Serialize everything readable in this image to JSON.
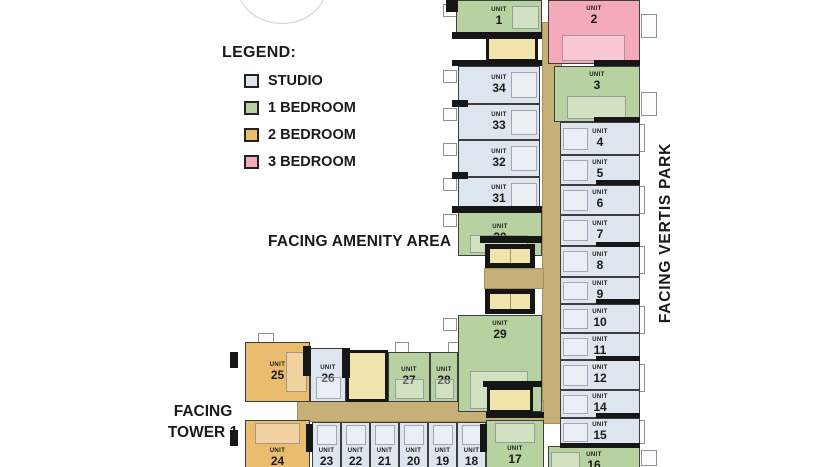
{
  "colors": {
    "studio": "#dde6ef",
    "br1": "#b8d1a0",
    "br2": "#e9bc6e",
    "br3": "#f4aab9",
    "corridor": "#c6b078",
    "service": "#f0e3ab",
    "wall": "#161616"
  },
  "legend": {
    "title": "LEGEND:",
    "items": [
      {
        "label": "STUDIO",
        "key": "studio"
      },
      {
        "label": "1 BEDROOM",
        "key": "br1"
      },
      {
        "label": "2 BEDROOM",
        "key": "br2"
      },
      {
        "label": "3 BEDROOM",
        "key": "br3"
      }
    ]
  },
  "labels": {
    "amenity": "FACING AMENITY AREA",
    "vertis": "FACING VERTIS PARK",
    "tower": "FACING\nTOWER 1"
  },
  "plan": {
    "unit_word": "UNIT",
    "units": [
      {
        "n": "1",
        "t": "br1",
        "x": 456,
        "y": 0,
        "w": 86,
        "h": 34,
        "o": "r"
      },
      {
        "n": "2",
        "t": "br3",
        "x": 548,
        "y": 0,
        "w": 92,
        "h": 64,
        "o": "b",
        "la": "t"
      },
      {
        "n": "3",
        "t": "br1",
        "x": 554,
        "y": 66,
        "w": 86,
        "h": 56,
        "o": "b",
        "la": "t"
      },
      {
        "n": "4",
        "t": "studio",
        "x": 560,
        "y": 122,
        "w": 80,
        "h": 33,
        "o": "l"
      },
      {
        "n": "5",
        "t": "studio",
        "x": 560,
        "y": 155,
        "w": 80,
        "h": 30,
        "o": "l"
      },
      {
        "n": "6",
        "t": "studio",
        "x": 560,
        "y": 185,
        "w": 80,
        "h": 30,
        "o": "l"
      },
      {
        "n": "7",
        "t": "studio",
        "x": 560,
        "y": 215,
        "w": 80,
        "h": 31,
        "o": "l"
      },
      {
        "n": "8",
        "t": "studio",
        "x": 560,
        "y": 246,
        "w": 80,
        "h": 31,
        "o": "l"
      },
      {
        "n": "9",
        "t": "studio",
        "x": 560,
        "y": 277,
        "w": 80,
        "h": 27,
        "o": "l"
      },
      {
        "n": "10",
        "t": "studio",
        "x": 560,
        "y": 304,
        "w": 80,
        "h": 29,
        "o": "l"
      },
      {
        "n": "11",
        "t": "studio",
        "x": 560,
        "y": 333,
        "w": 80,
        "h": 27,
        "o": "l"
      },
      {
        "n": "12",
        "t": "studio",
        "x": 560,
        "y": 360,
        "w": 80,
        "h": 30,
        "o": "l"
      },
      {
        "n": "14",
        "t": "studio",
        "x": 560,
        "y": 390,
        "w": 80,
        "h": 28,
        "o": "l"
      },
      {
        "n": "15",
        "t": "studio",
        "x": 560,
        "y": 418,
        "w": 80,
        "h": 28,
        "o": "l"
      },
      {
        "n": "16",
        "t": "br1",
        "x": 548,
        "y": 446,
        "w": 92,
        "h": 34,
        "o": "l",
        "la": "t"
      },
      {
        "n": "17",
        "t": "br1",
        "x": 486,
        "y": 420,
        "w": 58,
        "h": 50,
        "o": "t",
        "la": "b"
      },
      {
        "n": "18",
        "t": "studio",
        "x": 457,
        "y": 422,
        "w": 29,
        "h": 50,
        "o": "t",
        "la": "b"
      },
      {
        "n": "19",
        "t": "studio",
        "x": 428,
        "y": 422,
        "w": 29,
        "h": 50,
        "o": "t",
        "la": "b"
      },
      {
        "n": "20",
        "t": "studio",
        "x": 399,
        "y": 422,
        "w": 29,
        "h": 50,
        "o": "t",
        "la": "b"
      },
      {
        "n": "21",
        "t": "studio",
        "x": 370,
        "y": 422,
        "w": 29,
        "h": 50,
        "o": "t",
        "la": "b"
      },
      {
        "n": "22",
        "t": "studio",
        "x": 341,
        "y": 422,
        "w": 29,
        "h": 50,
        "o": "t",
        "la": "b"
      },
      {
        "n": "23",
        "t": "studio",
        "x": 312,
        "y": 422,
        "w": 29,
        "h": 50,
        "o": "t",
        "la": "b"
      },
      {
        "n": "24",
        "t": "br2",
        "x": 245,
        "y": 420,
        "w": 65,
        "h": 52,
        "o": "t",
        "la": "b"
      },
      {
        "n": "25",
        "t": "br2",
        "x": 245,
        "y": 342,
        "w": 65,
        "h": 60,
        "o": "r"
      },
      {
        "n": "26",
        "t": "studio",
        "x": 310,
        "y": 348,
        "w": 36,
        "h": 54,
        "o": "b"
      },
      {
        "n": "27",
        "t": "br1",
        "x": 388,
        "y": 352,
        "w": 42,
        "h": 50,
        "o": "b"
      },
      {
        "n": "28",
        "t": "br1",
        "x": 430,
        "y": 352,
        "w": 28,
        "h": 50,
        "o": "b"
      },
      {
        "n": "29",
        "t": "br1",
        "x": 458,
        "y": 315,
        "w": 84,
        "h": 97,
        "o": "b",
        "la": "t"
      },
      {
        "n": "30",
        "t": "br1",
        "x": 458,
        "y": 212,
        "w": 84,
        "h": 44,
        "o": "b"
      },
      {
        "n": "31",
        "t": "studio",
        "x": 458,
        "y": 177,
        "w": 82,
        "h": 35,
        "o": "r"
      },
      {
        "n": "32",
        "t": "studio",
        "x": 458,
        "y": 140,
        "w": 82,
        "h": 37,
        "o": "r"
      },
      {
        "n": "33",
        "t": "studio",
        "x": 458,
        "y": 104,
        "w": 82,
        "h": 36,
        "o": "r"
      },
      {
        "n": "34",
        "t": "studio",
        "x": 458,
        "y": 66,
        "w": 82,
        "h": 38,
        "o": "r"
      }
    ],
    "corridors": [
      {
        "x": 542,
        "y": 22,
        "w": 20,
        "h": 402
      },
      {
        "x": 484,
        "y": 268,
        "w": 60,
        "h": 21
      },
      {
        "x": 297,
        "y": 400,
        "w": 247,
        "h": 22
      }
    ],
    "service": [
      {
        "k": "stairs",
        "x": 486,
        "y": 36,
        "w": 52,
        "h": 26
      },
      {
        "k": "elevator",
        "x": 485,
        "y": 244,
        "w": 50,
        "h": 24
      },
      {
        "k": "elevator",
        "x": 485,
        "y": 289,
        "w": 50,
        "h": 25
      },
      {
        "k": "stairs",
        "x": 487,
        "y": 387,
        "w": 46,
        "h": 26
      },
      {
        "k": "stairs",
        "x": 346,
        "y": 350,
        "w": 42,
        "h": 52
      }
    ],
    "walls": [
      {
        "x": 452,
        "y": 32,
        "w": 90,
        "h": 7
      },
      {
        "x": 452,
        "y": 60,
        "w": 90,
        "h": 6
      },
      {
        "x": 452,
        "y": 206,
        "w": 90,
        "h": 7
      },
      {
        "x": 480,
        "y": 236,
        "w": 62,
        "h": 7
      },
      {
        "x": 483,
        "y": 381,
        "w": 59,
        "h": 6
      },
      {
        "x": 486,
        "y": 412,
        "w": 58,
        "h": 6
      },
      {
        "x": 303,
        "y": 346,
        "w": 8,
        "h": 30
      },
      {
        "x": 342,
        "y": 348,
        "w": 8,
        "h": 30
      },
      {
        "x": 306,
        "y": 424,
        "w": 7,
        "h": 28
      },
      {
        "x": 480,
        "y": 424,
        "w": 7,
        "h": 28
      },
      {
        "x": 594,
        "y": 60,
        "w": 46,
        "h": 6
      },
      {
        "x": 594,
        "y": 117,
        "w": 46,
        "h": 5
      },
      {
        "x": 596,
        "y": 180,
        "w": 44,
        "h": 5
      },
      {
        "x": 596,
        "y": 242,
        "w": 44,
        "h": 5
      },
      {
        "x": 596,
        "y": 299,
        "w": 44,
        "h": 5
      },
      {
        "x": 596,
        "y": 356,
        "w": 44,
        "h": 5
      },
      {
        "x": 596,
        "y": 413,
        "w": 44,
        "h": 5
      },
      {
        "x": 560,
        "y": 443,
        "w": 80,
        "h": 5
      },
      {
        "x": 452,
        "y": 100,
        "w": 16,
        "h": 7
      },
      {
        "x": 452,
        "y": 172,
        "w": 16,
        "h": 7
      },
      {
        "x": 446,
        "y": 0,
        "w": 12,
        "h": 12
      },
      {
        "x": 230,
        "y": 352,
        "w": 8,
        "h": 16
      },
      {
        "x": 230,
        "y": 430,
        "w": 8,
        "h": 16
      }
    ],
    "balconies": [
      {
        "x": 641,
        "y": 14,
        "w": 16,
        "h": 24
      },
      {
        "x": 641,
        "y": 92,
        "w": 16,
        "h": 24
      },
      {
        "x": 625,
        "y": 124,
        "w": 20,
        "h": 28
      },
      {
        "x": 625,
        "y": 186,
        "w": 20,
        "h": 28
      },
      {
        "x": 625,
        "y": 246,
        "w": 20,
        "h": 28
      },
      {
        "x": 625,
        "y": 306,
        "w": 20,
        "h": 28
      },
      {
        "x": 625,
        "y": 364,
        "w": 20,
        "h": 28
      },
      {
        "x": 625,
        "y": 420,
        "w": 20,
        "h": 24
      },
      {
        "x": 641,
        "y": 450,
        "w": 16,
        "h": 16
      },
      {
        "x": 443,
        "y": 4,
        "w": 14,
        "h": 13
      },
      {
        "x": 443,
        "y": 70,
        "w": 14,
        "h": 13
      },
      {
        "x": 443,
        "y": 108,
        "w": 14,
        "h": 13
      },
      {
        "x": 443,
        "y": 143,
        "w": 14,
        "h": 13
      },
      {
        "x": 443,
        "y": 178,
        "w": 14,
        "h": 13
      },
      {
        "x": 443,
        "y": 214,
        "w": 14,
        "h": 13
      },
      {
        "x": 443,
        "y": 318,
        "w": 14,
        "h": 13
      },
      {
        "x": 258,
        "y": 333,
        "w": 16,
        "h": 11
      },
      {
        "x": 395,
        "y": 342,
        "w": 14,
        "h": 11
      },
      {
        "x": 448,
        "y": 342,
        "w": 12,
        "h": 11
      }
    ]
  }
}
